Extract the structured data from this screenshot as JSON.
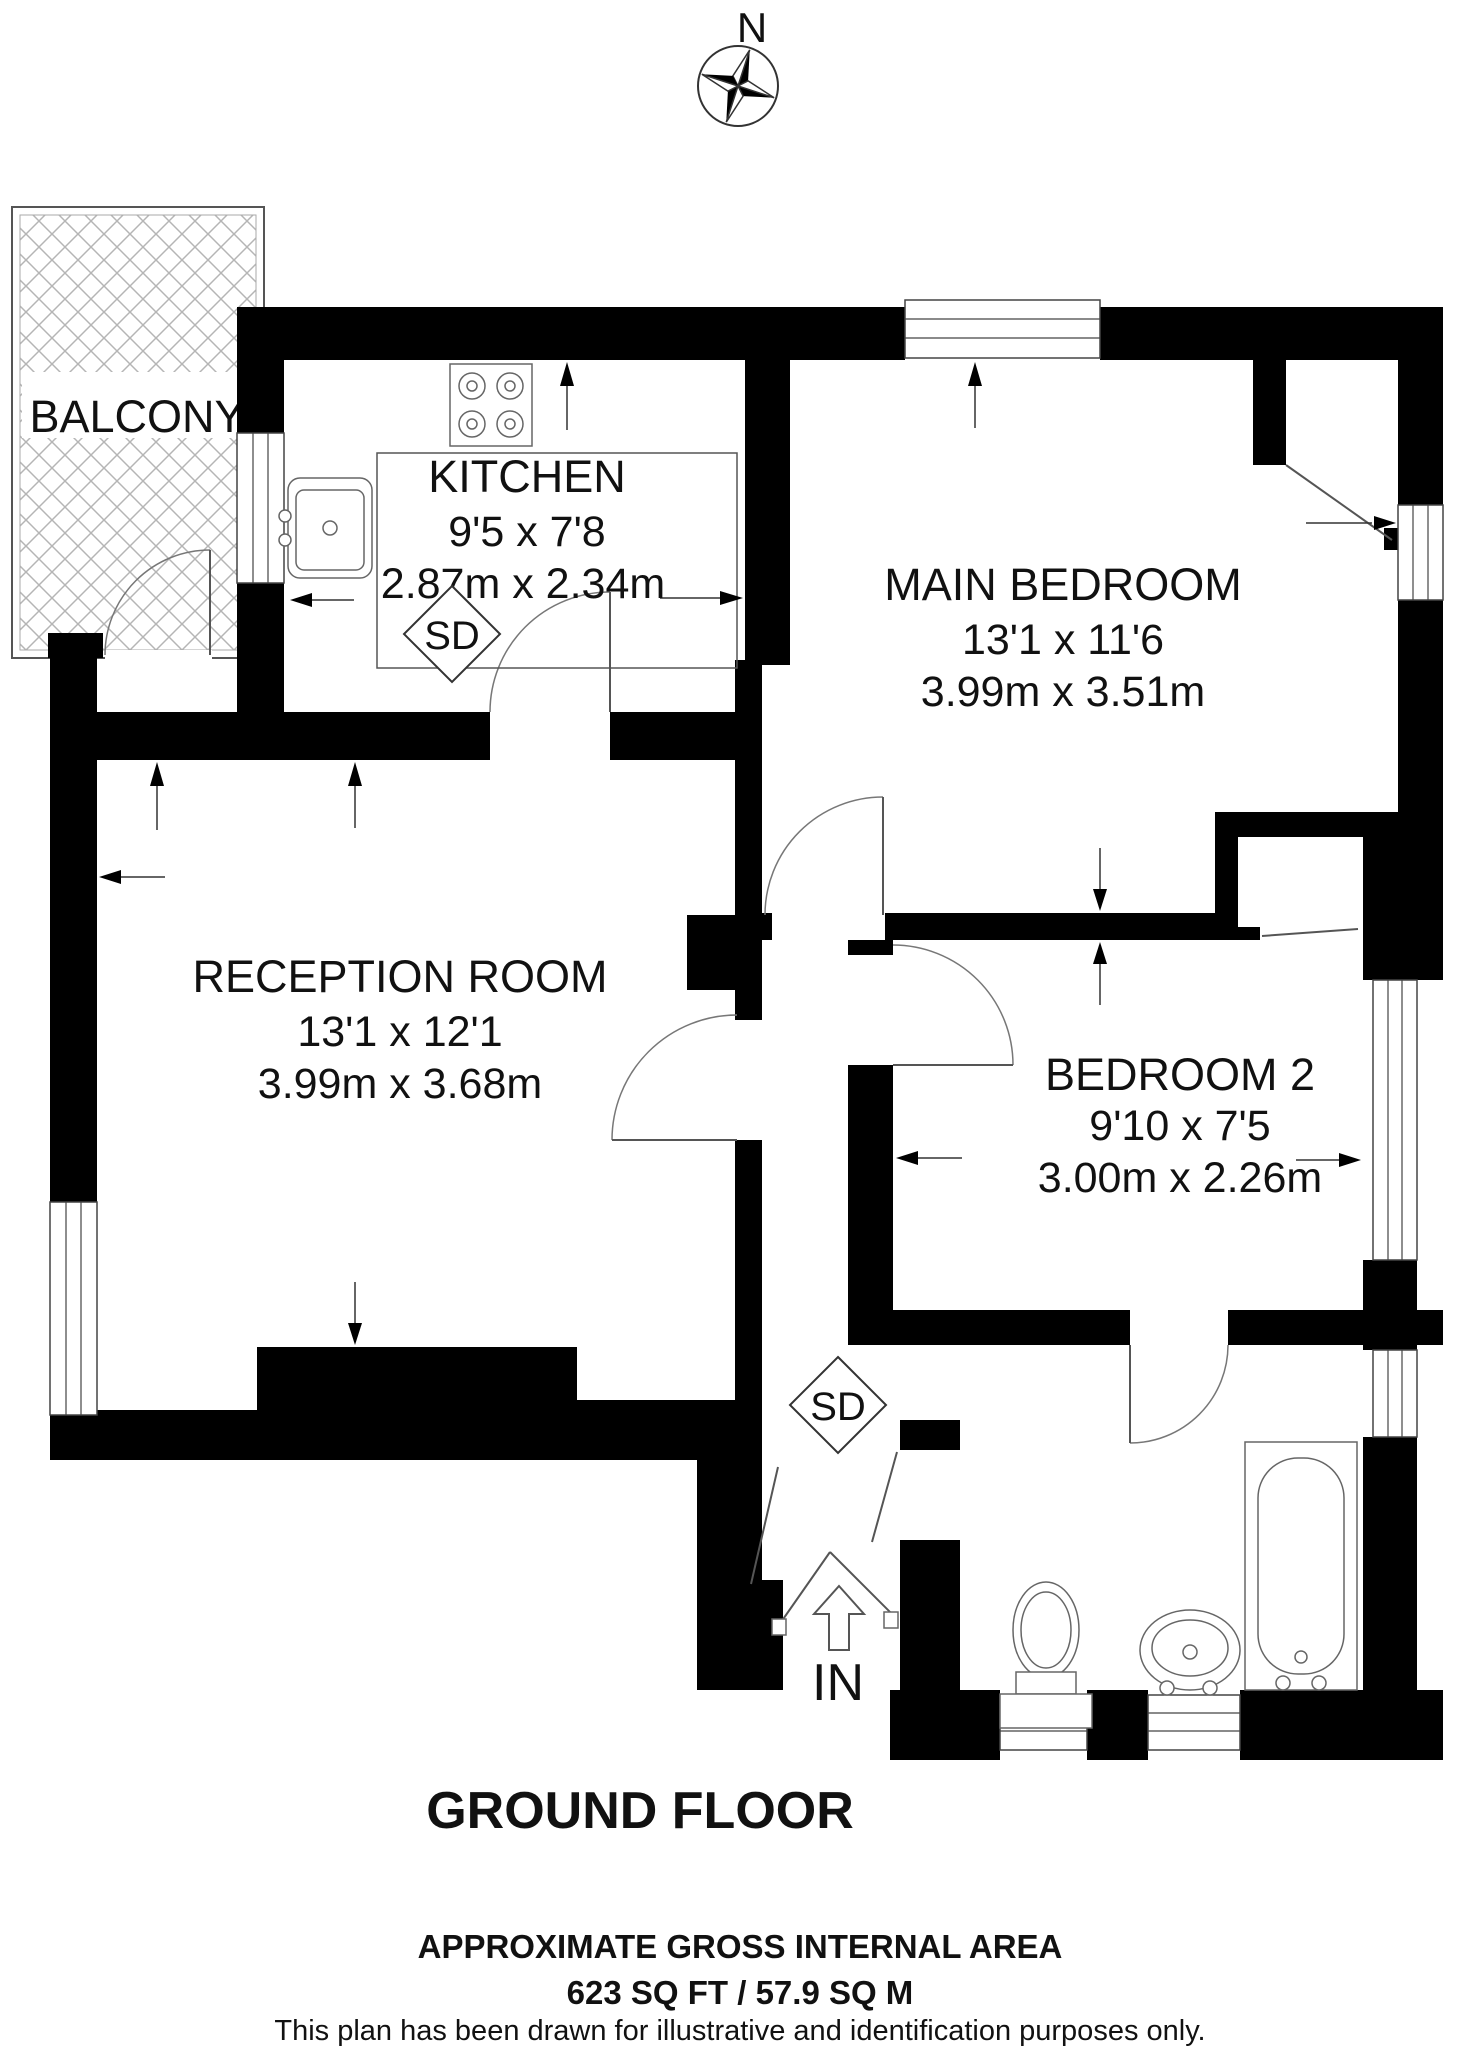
{
  "title": "GROUND FLOOR",
  "compass": {
    "north_label": "N"
  },
  "rooms": [
    {
      "name": "BALCONY"
    },
    {
      "name": "KITCHEN",
      "dims_imperial": "9'5 x 7'8",
      "dims_metric": "2.87m x 2.34m"
    },
    {
      "name": "MAIN BEDROOM",
      "dims_imperial": "13'1 x 11'6",
      "dims_metric": "3.99m x 3.51m"
    },
    {
      "name": "RECEPTION ROOM",
      "dims_imperial": "13'1 x 12'1",
      "dims_metric": "3.99m x 3.68m"
    },
    {
      "name": "BEDROOM 2",
      "dims_imperial": "9'10 x 7'5",
      "dims_metric": "3.00m x 2.26m"
    }
  ],
  "markers": {
    "smoke_detector": "SD",
    "entrance": "IN"
  },
  "footer": {
    "area_heading": "APPROXIMATE GROSS INTERNAL AREA",
    "area_value": "623 SQ FT / 57.9 SQ M",
    "disclaimer": "This plan has been drawn for illustrative and identification purposes only."
  },
  "colors": {
    "wall": "#000000",
    "hatch": "#b5b5b5",
    "line": "#555555"
  }
}
